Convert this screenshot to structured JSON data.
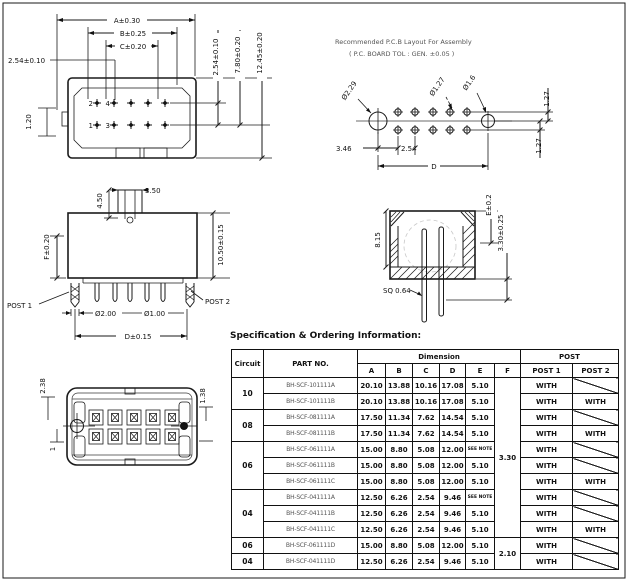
{
  "views": {
    "plan": {
      "a": "A±0.30",
      "b": "B±0.25",
      "c": "C±0.20",
      "pitch_left": "2.54±0.10",
      "tab_h": "1.20",
      "pin2": "2",
      "pin4": "4",
      "pin1": "1",
      "pin3": "3",
      "pitch_right": "2.54±0.10",
      "h1": "7.80±0.20",
      "h2": "12.45±0.20"
    },
    "pcb": {
      "note1": "Recommended P.C.B Layout For Assembly",
      "note2": "( P.C. BOARD TOL : GEN. ±0.05 )",
      "hole_l": "Ø2.29",
      "hole_m": "Ø1.27",
      "hole_r": "Ø1.6",
      "d346": "3.46",
      "d254": "2.54",
      "span": "D",
      "row1": "1.27",
      "row2": "1.27"
    },
    "side": {
      "boss_h": "4.50",
      "boss_w": "3.50",
      "body_h": "10.50±0.15",
      "f": "F±0.20",
      "post1": "POST 1",
      "post2": "POST 2",
      "dia2": "Ø2.00",
      "dia1": "Ø1.00",
      "span": "D±0.15"
    },
    "section": {
      "h815": "8.15",
      "e": "E±0.2",
      "d330": "3.30±0.25",
      "sq": "SQ 0.64"
    },
    "bottom": {
      "d238": "2.38",
      "d138": "1.38",
      "one": "1"
    }
  },
  "table": {
    "title": "Specification & Ordering Information:",
    "headers": {
      "circuit": "Circuit",
      "part_no": "PART NO.",
      "dimension": "Dimension",
      "post": "POST",
      "dim_cols": [
        "A",
        "B",
        "C",
        "D",
        "E",
        "F"
      ],
      "post_cols": [
        "POST 1",
        "POST 2"
      ]
    },
    "circuit_groups": [
      {
        "label": "10",
        "rows": 2
      },
      {
        "label": "08",
        "rows": 2
      },
      {
        "label": "06",
        "rows": 3
      },
      {
        "label": "04",
        "rows": 3
      },
      {
        "label": "06",
        "rows": 1
      },
      {
        "label": "04",
        "rows": 1
      }
    ],
    "f_groups": [
      {
        "value": "3.30",
        "rows": 10
      },
      {
        "value": "2.10",
        "rows": 2
      }
    ],
    "rows": [
      {
        "part": "BH-SCF-101111A",
        "a": "20.10",
        "b": "13.88",
        "c": "10.16",
        "d": "17.08",
        "e": "5.10",
        "post1": "WITH",
        "post2": "slash"
      },
      {
        "part": "BH-SCF-101111B",
        "a": "20.10",
        "b": "13.88",
        "c": "10.16",
        "d": "17.08",
        "e": "5.10",
        "post1": "WITH",
        "post2": "WITH"
      },
      {
        "part": "BH-SCF-081111A",
        "a": "17.50",
        "b": "11.34",
        "c": "7.62",
        "d": "14.54",
        "e": "5.10",
        "post1": "WITH",
        "post2": "slash"
      },
      {
        "part": "BH-SCF-081111B",
        "a": "17.50",
        "b": "11.34",
        "c": "7.62",
        "d": "14.54",
        "e": "5.10",
        "post1": "WITH",
        "post2": "WITH"
      },
      {
        "part": "BH-SCF-061111A",
        "a": "15.00",
        "b": "8.80",
        "c": "5.08",
        "d": "12.00",
        "e": "SEE NOTE",
        "post1": "WITH",
        "post2": "slash"
      },
      {
        "part": "BH-SCF-061111B",
        "a": "15.00",
        "b": "8.80",
        "c": "5.08",
        "d": "12.00",
        "e": "5.10",
        "post1": "WITH",
        "post2": "slash"
      },
      {
        "part": "BH-SCF-061111C",
        "a": "15.00",
        "b": "8.80",
        "c": "5.08",
        "d": "12.00",
        "e": "5.10",
        "post1": "WITH",
        "post2": "WITH"
      },
      {
        "part": "BH-SCF-041111A",
        "a": "12.50",
        "b": "6.26",
        "c": "2.54",
        "d": "9.46",
        "e": "SEE NOTE",
        "post1": "WITH",
        "post2": "slash"
      },
      {
        "part": "BH-SCF-041111B",
        "a": "12.50",
        "b": "6.26",
        "c": "2.54",
        "d": "9.46",
        "e": "5.10",
        "post1": "WITH",
        "post2": "slash"
      },
      {
        "part": "BH-SCF-041111C",
        "a": "12.50",
        "b": "6.26",
        "c": "2.54",
        "d": "9.46",
        "e": "5.10",
        "post1": "WITH",
        "post2": "WITH"
      },
      {
        "part": "BH-SCF-061111D",
        "a": "15.00",
        "b": "8.80",
        "c": "5.08",
        "d": "12.00",
        "e": "5.10",
        "post1": "WITH",
        "post2": "slash"
      },
      {
        "part": "BH-SCF-041111D",
        "a": "12.50",
        "b": "6.26",
        "c": "2.54",
        "d": "9.46",
        "e": "5.10",
        "post1": "WITH",
        "post2": "slash"
      }
    ]
  }
}
